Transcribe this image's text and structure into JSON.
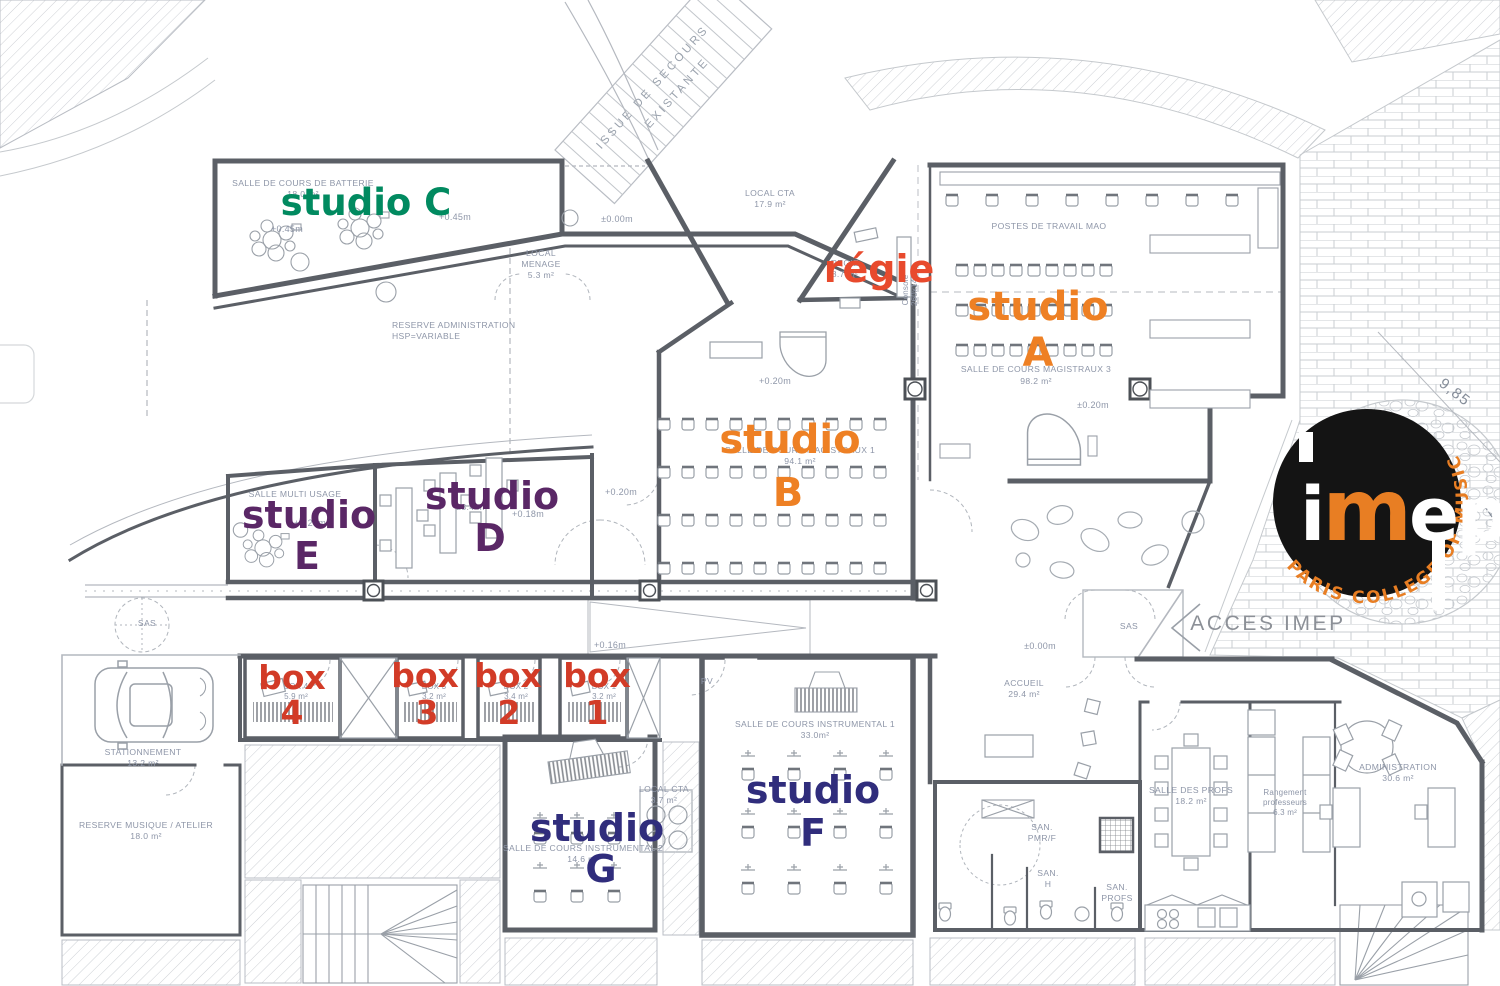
{
  "big_labels": {
    "studio_c": {
      "text": "studio C",
      "color": "#018a60"
    },
    "studio_e": {
      "word": "studio",
      "letter": "E",
      "color": "#5a2766"
    },
    "studio_d": {
      "word": "studio",
      "letter": "D",
      "color": "#5a2766"
    },
    "studio_b": {
      "word": "studio",
      "letter": "B",
      "color": "#ee8024"
    },
    "studio_a": {
      "word": "studio",
      "letter": "A",
      "color": "#ee8024"
    },
    "studio_f": {
      "word": "studio",
      "letter": "F",
      "color": "#302d7c"
    },
    "studio_g": {
      "word": "studio",
      "letter": "G",
      "color": "#302d7c"
    },
    "regie": {
      "text": "régie",
      "color": "#e84a2d"
    },
    "box_color": "#d23b27",
    "boxes": [
      {
        "word": "box",
        "num": "4"
      },
      {
        "word": "box",
        "num": "3"
      },
      {
        "word": "box",
        "num": "2"
      },
      {
        "word": "box",
        "num": "1"
      }
    ]
  },
  "rooms": [
    {
      "id": "salle-batterie",
      "lines": [
        "SALLE DE COURS DE BATTERIE",
        "18.0 m²"
      ]
    },
    {
      "id": "local-menage",
      "lines": [
        "LOCAL",
        "MENAGE",
        "5.3 m²"
      ]
    },
    {
      "id": "reserve-admin",
      "lines": [
        "RESERVE ADMINISTRATION",
        "HSP=VARIABLE"
      ]
    },
    {
      "id": "local-cta-1",
      "lines": [
        "LOCAL CTA",
        "17.9 m²"
      ]
    },
    {
      "id": "postes-mao",
      "lines": [
        "POSTES DE TRAVAIL MAO"
      ]
    },
    {
      "id": "regie",
      "lines": [
        "REGIE",
        "8.7 m²"
      ]
    },
    {
      "id": "magistraux-3",
      "lines": [
        "SALLE DE COURS MAGISTRAUX 3",
        "98.2 m²"
      ]
    },
    {
      "id": "magistraux-1",
      "lines": [
        "SALLE DE COURS MAGISTRAUX 1",
        "94.1 m²"
      ]
    },
    {
      "id": "salle-multi-usage",
      "lines": [
        "SALLE MULTI USAGE"
      ]
    },
    {
      "id": "salle-d-area",
      "lines": [
        "23.4 m²"
      ]
    },
    {
      "id": "sas-left",
      "lines": [
        "SAS"
      ]
    },
    {
      "id": "sas-right",
      "lines": [
        "SAS"
      ]
    },
    {
      "id": "accueil",
      "lines": [
        "ACCUEIL",
        "29.4 m²"
      ]
    },
    {
      "id": "administration",
      "lines": [
        "ADMINISTRATION",
        "30.6 m²"
      ]
    },
    {
      "id": "salle-des-profs",
      "lines": [
        "SALLE DES PROFS",
        "18.2 m²"
      ]
    },
    {
      "id": "rangement",
      "lines": [
        "Rangement",
        "professeurs",
        "6.3 m²"
      ]
    },
    {
      "id": "san-pmrf",
      "lines": [
        "SAN.",
        "PMR/F"
      ]
    },
    {
      "id": "san-h",
      "lines": [
        "SAN.",
        "H"
      ]
    },
    {
      "id": "san-profs",
      "lines": [
        "SAN.",
        "PROFS"
      ]
    },
    {
      "id": "stationnement",
      "lines": [
        "STATIONNEMENT",
        "13.2 m²"
      ]
    },
    {
      "id": "reserve-musique",
      "lines": [
        "RESERVE MUSIQUE / ATELIER",
        "18.0 m²"
      ]
    },
    {
      "id": "instrumental-2",
      "lines": [
        "SALLE DE COURS INSTRUMENTAL 2",
        "14.6 m²"
      ]
    },
    {
      "id": "local-cta-2",
      "lines": [
        "LOCAL CTA",
        "3.7 m²"
      ]
    },
    {
      "id": "instrumental-1",
      "lines": [
        "SALLE DE COURS INSTRUMENTAL 1",
        "33.0m²"
      ]
    },
    {
      "id": "box-4",
      "lines": [
        "BOX 4",
        "5.9 m²"
      ]
    },
    {
      "id": "box-3",
      "lines": [
        "BOX 3",
        "3.2 m²"
      ]
    },
    {
      "id": "box-2",
      "lines": [
        "BOX 2",
        "3.4 m²"
      ]
    },
    {
      "id": "box-1",
      "lines": [
        "BOX 1",
        "3.2 m²"
      ]
    },
    {
      "id": "pv",
      "lines": [
        "PV"
      ]
    },
    {
      "id": "console",
      "lines": [
        "Console",
        "260x140"
      ]
    }
  ],
  "elevations": [
    {
      "text": "+0.45m"
    },
    {
      "text": "+0.45m"
    },
    {
      "text": "±0.00m"
    },
    {
      "text": "+0.20m"
    },
    {
      "text": "±0.20m"
    },
    {
      "text": "+0.20m"
    },
    {
      "text": "+0.16m"
    },
    {
      "text": "±0.00m"
    },
    {
      "text": "+0.18m"
    },
    {
      "text": "+0.20m"
    }
  ],
  "dimensions": [
    {
      "text": "9,85"
    },
    {
      "text": "11,9"
    }
  ],
  "stair_label": {
    "line1": "ISSUE DE SECOURS",
    "line2": "EXISTANTE"
  },
  "access_label": "ACCES IMEP",
  "logo": {
    "wordmark_i": "i",
    "wordmark_m": "m",
    "wordmark_ep": "ep",
    "ring": "PARIS COLLEGE OF MUSIC",
    "bg": "#141414",
    "accent": "#e87e23"
  }
}
